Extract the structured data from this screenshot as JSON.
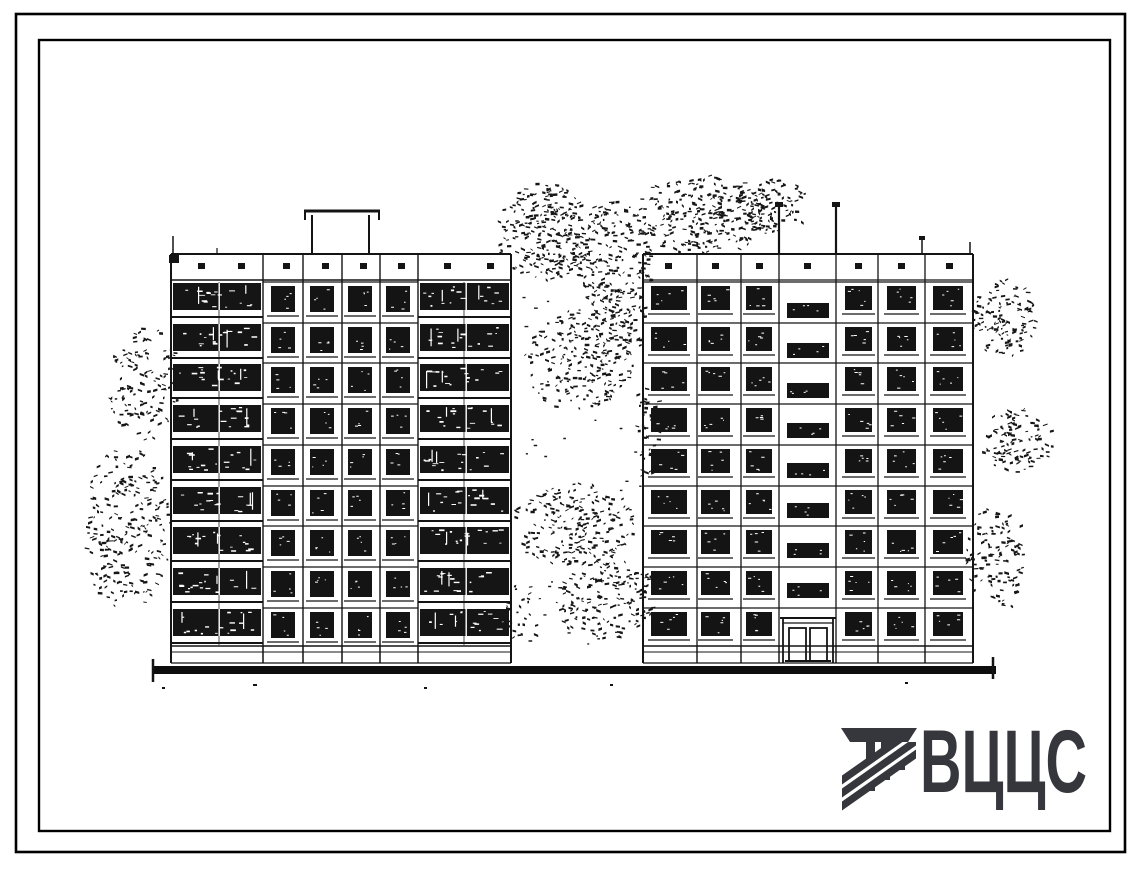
{
  "sheet": {
    "background": "#ffffff",
    "ink": "#141414",
    "description": "Typical-project facade drawing, two 9-storey panel building elevations with trees"
  },
  "drawing": {
    "type": "building-elevations",
    "left_building": {
      "floors": 9,
      "window_columns": 4,
      "balcony_stacks": 2,
      "has_roof_penthouse": true
    },
    "right_building": {
      "floors": 9,
      "window_bays": 6,
      "stair_window_column": 1,
      "entrance": "double-door"
    }
  },
  "logo": {
    "text": "ВЦЦС",
    "color": "#36363d",
    "emblem": "striped-column-mark"
  }
}
